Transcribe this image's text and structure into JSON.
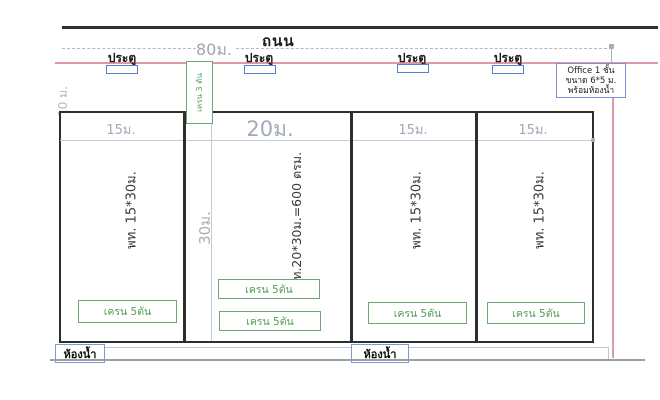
{
  "drawing": {
    "road_label": "ถนน",
    "road_width_label": "80ม.",
    "setback_label": "10 ม.",
    "depth_label": "30ม."
  },
  "doors": [
    {
      "label": "ประตู"
    },
    {
      "label": "ประตู"
    },
    {
      "label": "ประตู"
    },
    {
      "label": "ประตู"
    }
  ],
  "office_note": {
    "line1": "Office 1 ชั้น",
    "line2": "ขนาด 6*5 ม.",
    "line3": "พร้อมห้องน้ำ"
  },
  "crane_corridor_label": "เครน 3 ตัน",
  "sections": [
    {
      "width_label": "15ม.",
      "area_label": "พท. 15*30ม."
    },
    {
      "width_label": "20ม.",
      "area_label": "พท.20*30ม.=600 ตรม."
    },
    {
      "width_label": "15ม.",
      "area_label": "พท. 15*30ม."
    },
    {
      "width_label": "15ม.",
      "area_label": "พท. 15*30ม."
    }
  ],
  "cranes": [
    {
      "label": "เครน 5ตัน"
    },
    {
      "label": "เครน 5ตัน"
    },
    {
      "label": "เครน 5ตัน"
    },
    {
      "label": "เครน 5ตัน"
    },
    {
      "label": "เครน 5ตัน"
    }
  ],
  "bathrooms": [
    {
      "label": "ห้องน้ำ"
    },
    {
      "label": "ห้องน้ำ"
    }
  ],
  "colors": {
    "pink_line": "#dd9aa5",
    "blue_construction": "#b7c6da",
    "door_blue": "#5b7fd0",
    "office_border": "#8090d8",
    "green": "#71a573",
    "green_text": "#4f9e55",
    "wall": "#2e2e2e",
    "dim_text": "#a3aab6"
  }
}
